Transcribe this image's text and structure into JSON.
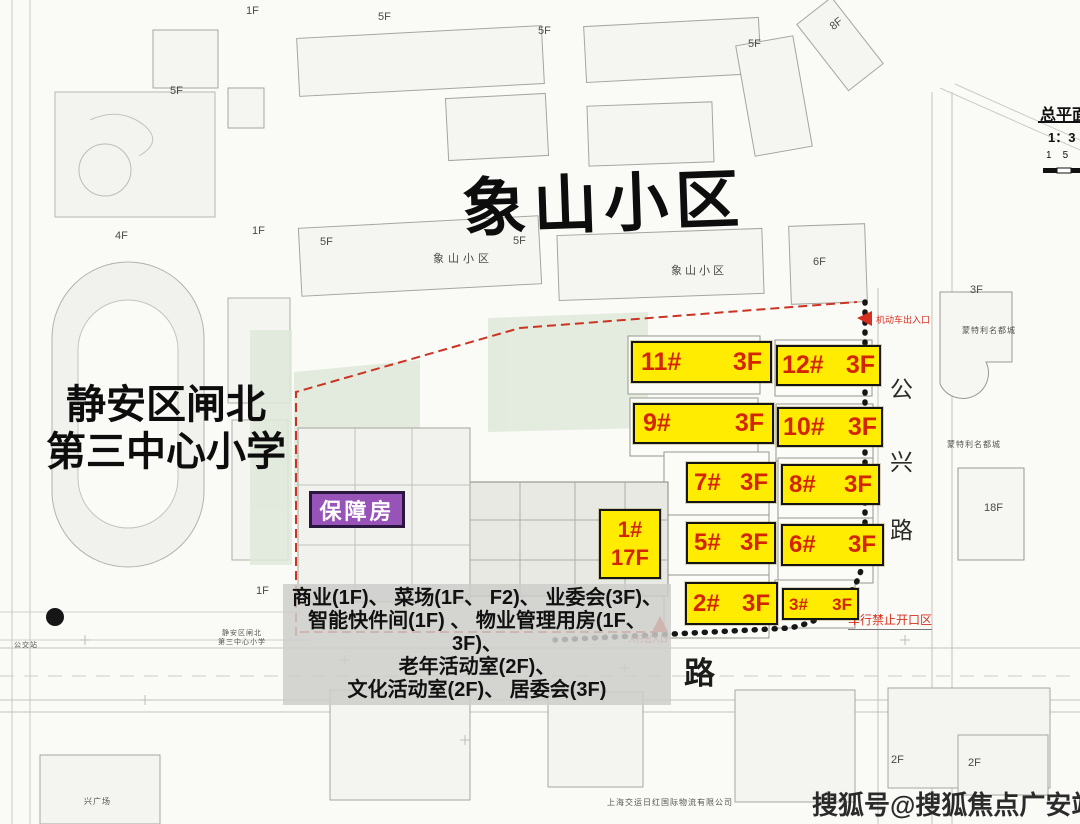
{
  "titles": {
    "main": "象山小区",
    "school_line1": "静安区闸北",
    "school_line2": "第三中心小学",
    "badge": "保障房"
  },
  "buildings": [
    {
      "label": "11#",
      "floors": "3F"
    },
    {
      "label": "12#",
      "floors": "3F"
    },
    {
      "label": "9#",
      "floors": "3F"
    },
    {
      "label": "10#",
      "floors": "3F"
    },
    {
      "label": "7#",
      "floors": "3F"
    },
    {
      "label": "8#",
      "floors": "3F"
    },
    {
      "label": "1#",
      "floors": "17F"
    },
    {
      "label": "5#",
      "floors": "3F"
    },
    {
      "label": "6#",
      "floors": "3F"
    },
    {
      "label": "2#",
      "floors": "3F"
    },
    {
      "label": "3#",
      "floors": "3F"
    }
  ],
  "facilities_lines": [
    "商业(1F)、 菜场(1F、 F2)、 业委会(3F)、",
    "智能快件间(1F) 、 物业管理用房(1F、 3F)、",
    "老年活动室(2F)、",
    "文化活动室(2F)、 居委会(3F)"
  ],
  "roads": {
    "gongxing_char1": "公",
    "gongxing_char2": "兴",
    "gongxing_char3": "路",
    "bottom_road_char": "路"
  },
  "legend": {
    "title": "总平面",
    "scale": "1：3",
    "ticks": "1    5"
  },
  "watermark": "搜狐号@搜狐焦点广安站",
  "annotations": {
    "xiangshan_small": "象山小区",
    "montery": "蒙特利名都城",
    "school_small_1": "静安区闸北",
    "school_small_2": "第三中心小学",
    "logistics": "上海交运日红国际物流有限公司",
    "bus_stop": "公交站",
    "plaza": "兴广场",
    "no_vehicle_zone": "车行禁止开口区",
    "vehicle_entrance": "机动车出入口",
    "pedestrian_entrance": "人行出入口"
  },
  "floor_tags": [
    "1F",
    "5F",
    "5F",
    "5F",
    "8F",
    "5F",
    "4F",
    "1F",
    "5F",
    "5F",
    "6F",
    "3F",
    "1F",
    "18F",
    "2F",
    "2F"
  ],
  "colors": {
    "label_bg": "#ffec00",
    "label_text": "#d32600",
    "badge_bg": "#9753b8",
    "accent_red": "#d63020",
    "ink": "#141414",
    "map_line": "#aaaaa4"
  }
}
